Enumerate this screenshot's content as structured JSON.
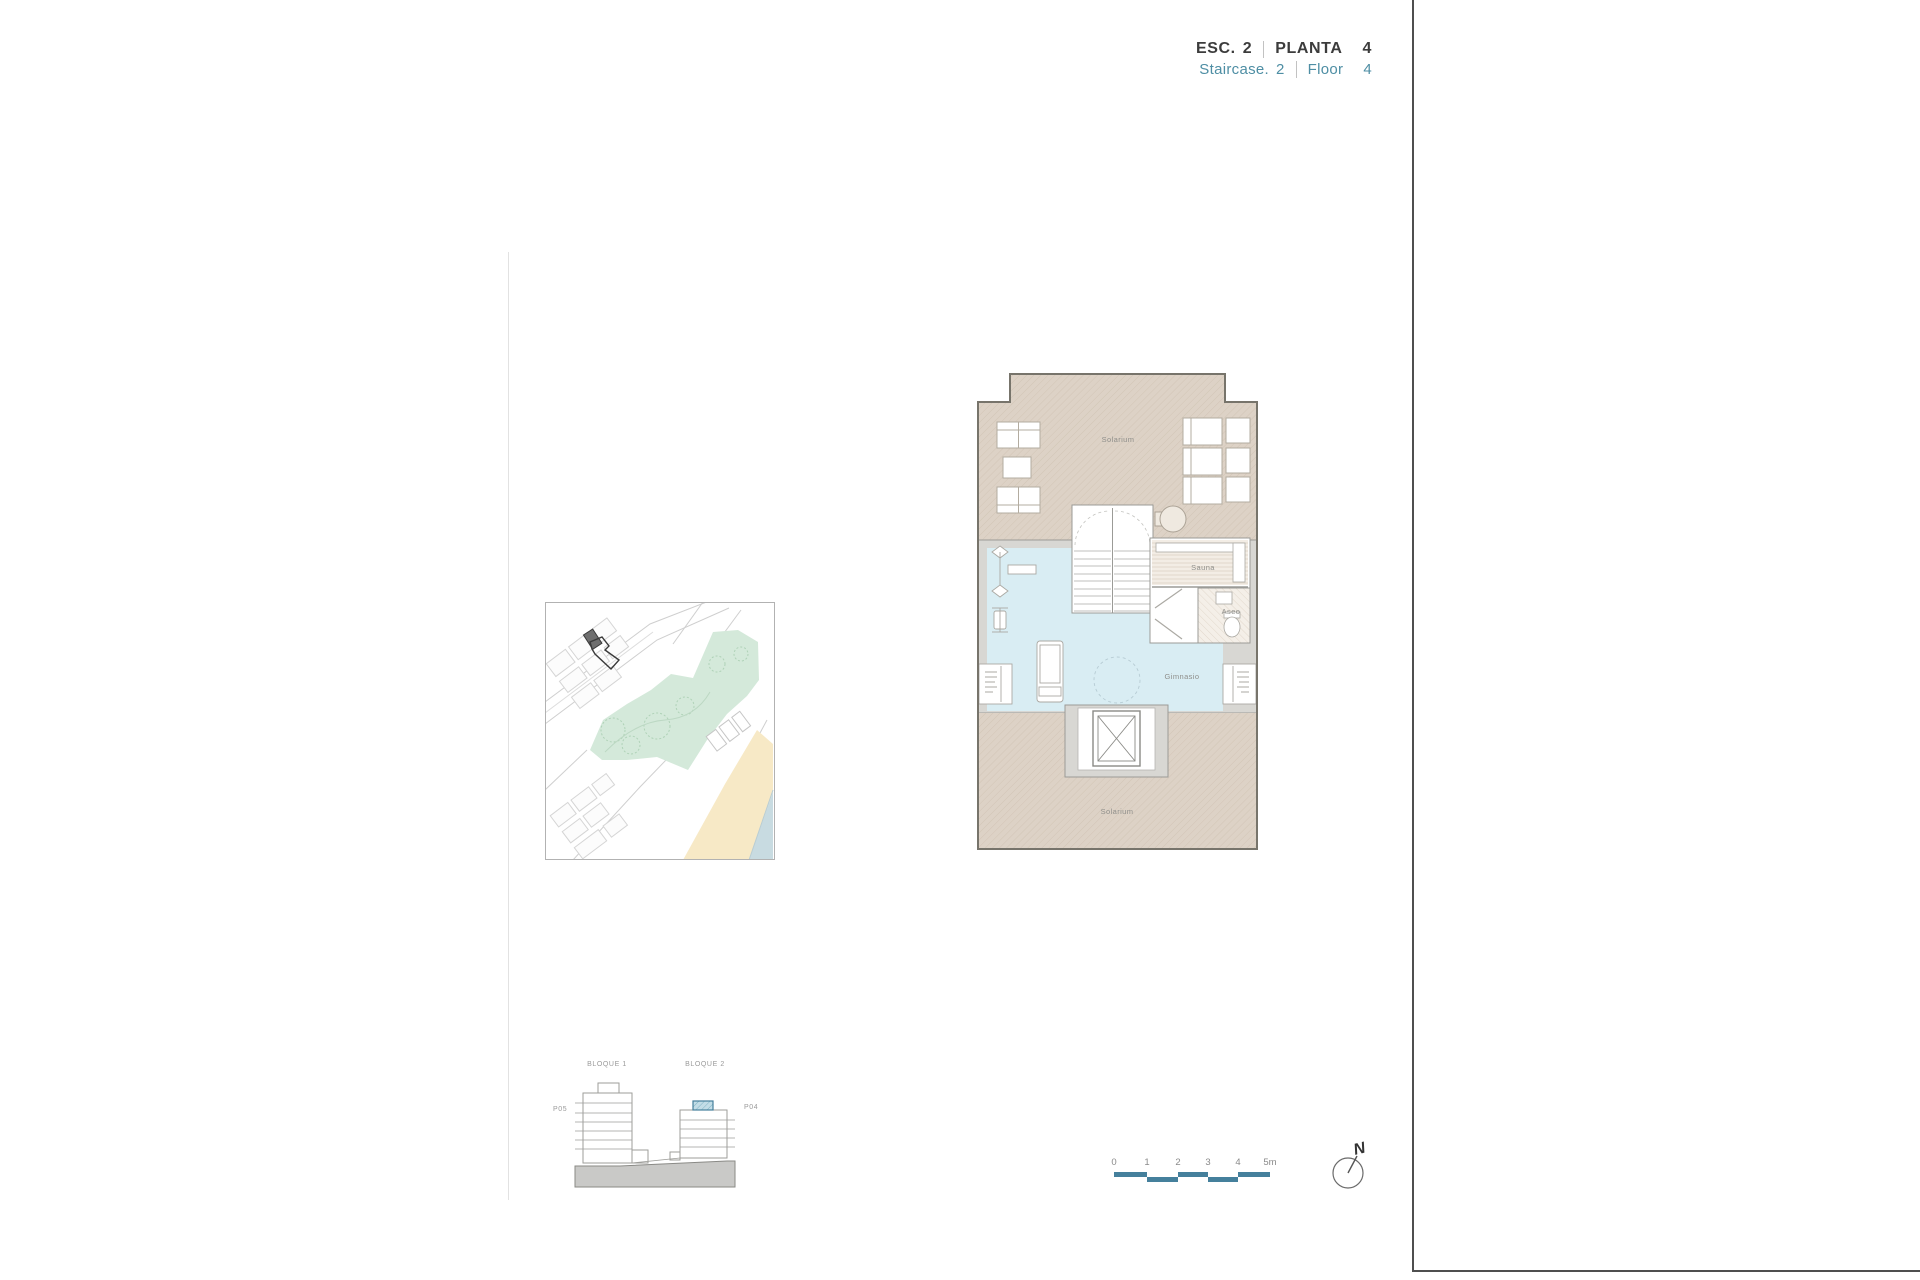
{
  "header": {
    "esc_label": "ESC.",
    "esc_value": "2",
    "planta_label": "PLANTA",
    "planta_value": "4",
    "staircase_label": "Staircase.",
    "staircase_value": "2",
    "floor_label": "Floor",
    "floor_value": "4"
  },
  "floor_plan": {
    "solarium_top_label": "Solarium",
    "solarium_bottom_label": "Solarium",
    "sauna_label": "Sauna",
    "aseo_label": "Aseo",
    "gym_label": "Gimnasio"
  },
  "elevation": {
    "block1_label": "BLOQUE 1",
    "block2_label": "BLOQUE 2",
    "left_floor_label": "P05",
    "right_floor_label": "P04"
  },
  "scale_bar": {
    "tick_labels": [
      "0",
      "1",
      "2",
      "3",
      "4",
      "5m"
    ]
  },
  "compass": {
    "north_label": "N"
  },
  "colors": {
    "accent_teal": "#45809c",
    "teal_text": "#4e8ea4",
    "solarium_beige": "#ddd2c6",
    "gym_blue": "#d9edf3",
    "wall_gray": "#d8d7d3",
    "outline_dark": "#77746b",
    "park_green": "#d4e9da",
    "beach_sand": "#f7e9c6",
    "sea_water": "#c8dbe1"
  }
}
